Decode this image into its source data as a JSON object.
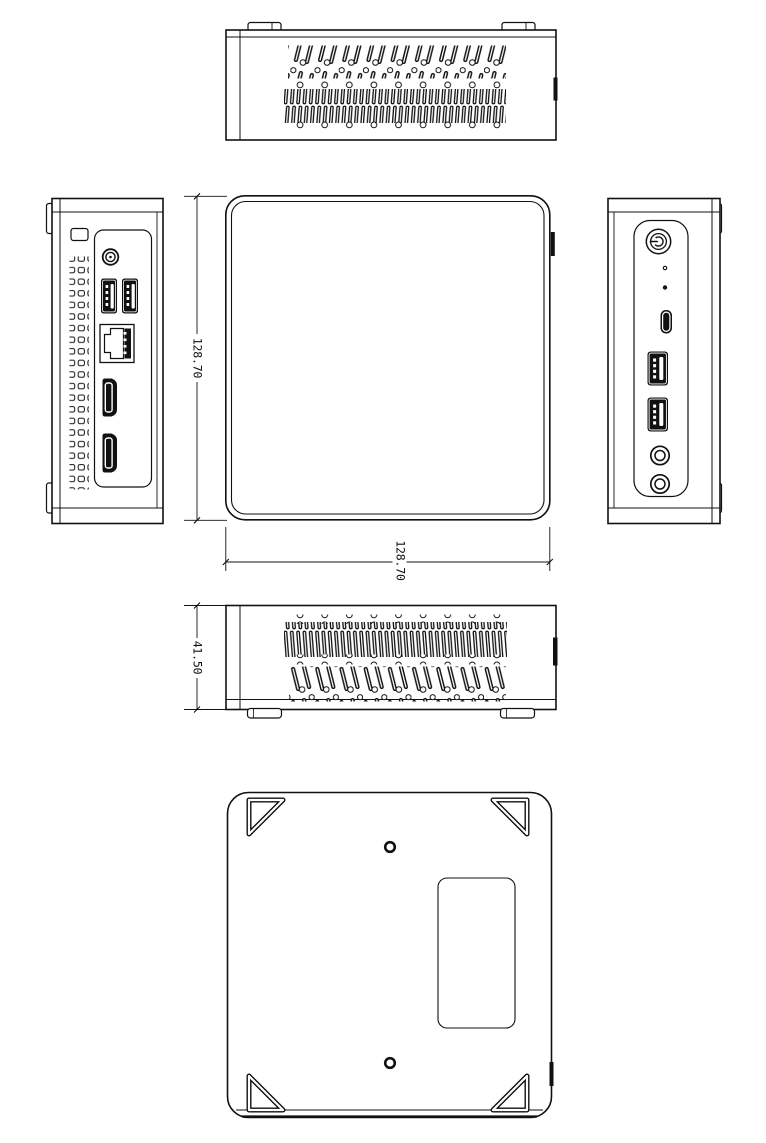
{
  "drawing": {
    "type": "mini-pc-technical-drawing",
    "dimensions": {
      "square_height_label": "128.70",
      "square_width_label": "128.70",
      "device_height_label": "41.50"
    },
    "colors": {
      "line": "#111111",
      "background": "#ffffff"
    }
  }
}
